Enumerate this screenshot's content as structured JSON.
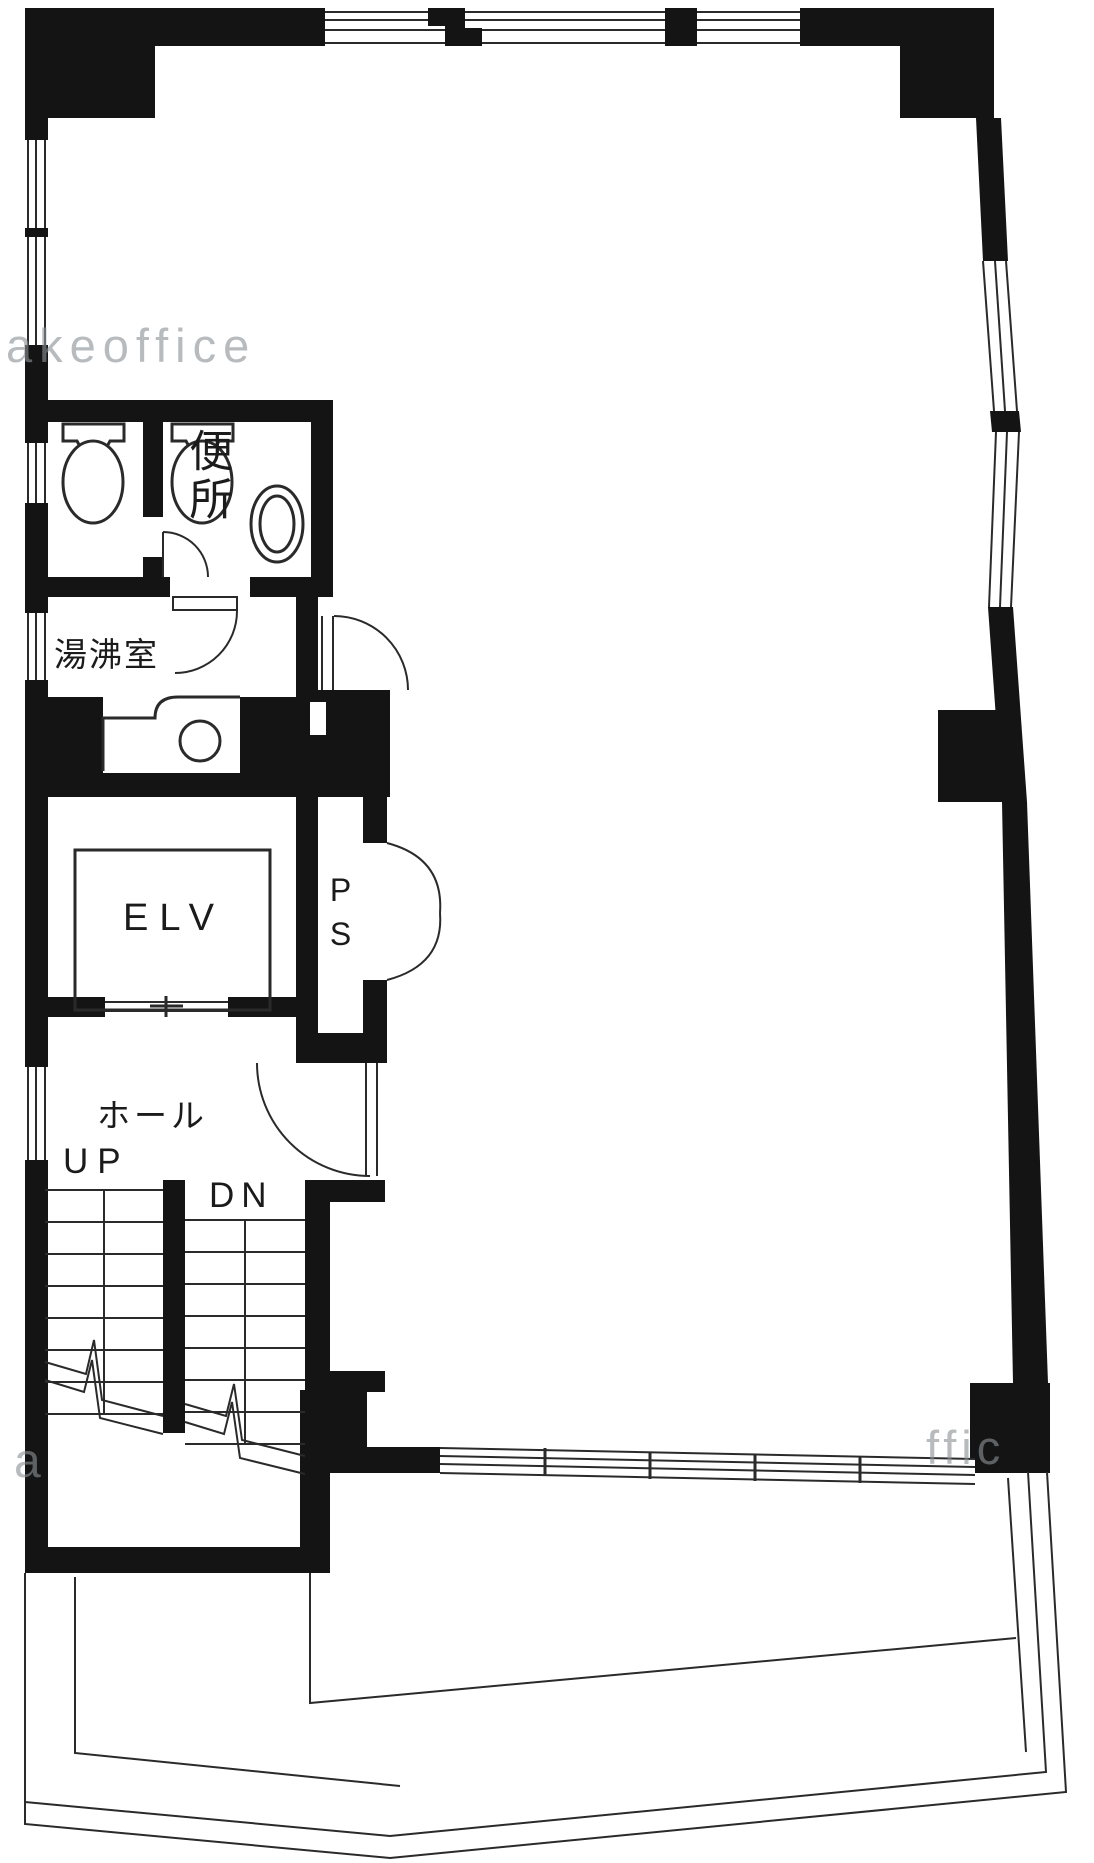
{
  "document": {
    "type": "architectural-floor-plan",
    "language": "Japanese"
  },
  "rooms": {
    "toilet_label": "便所",
    "kitchenette_label": "湯沸室",
    "elevator_label": "ELV",
    "pipe_shaft_label": "PS",
    "hall_label": "ホール"
  },
  "stairs": {
    "up_label": "UP",
    "down_label": "DN"
  },
  "watermarks": {
    "top_left": "akeoffice",
    "bottom_right": "ffic",
    "bottom_left": "a"
  },
  "icons": [
    "toilet-bowl-icon",
    "toilet-bowl-icon",
    "wash-basin-icon",
    "kitchen-sink-icon",
    "door-swing-arc",
    "stair-treads"
  ],
  "colors": {
    "wall": "#141414",
    "line": "#2a2a2a",
    "paper": "#ffffff",
    "watermark": "rgba(138,146,150,0.62)"
  }
}
